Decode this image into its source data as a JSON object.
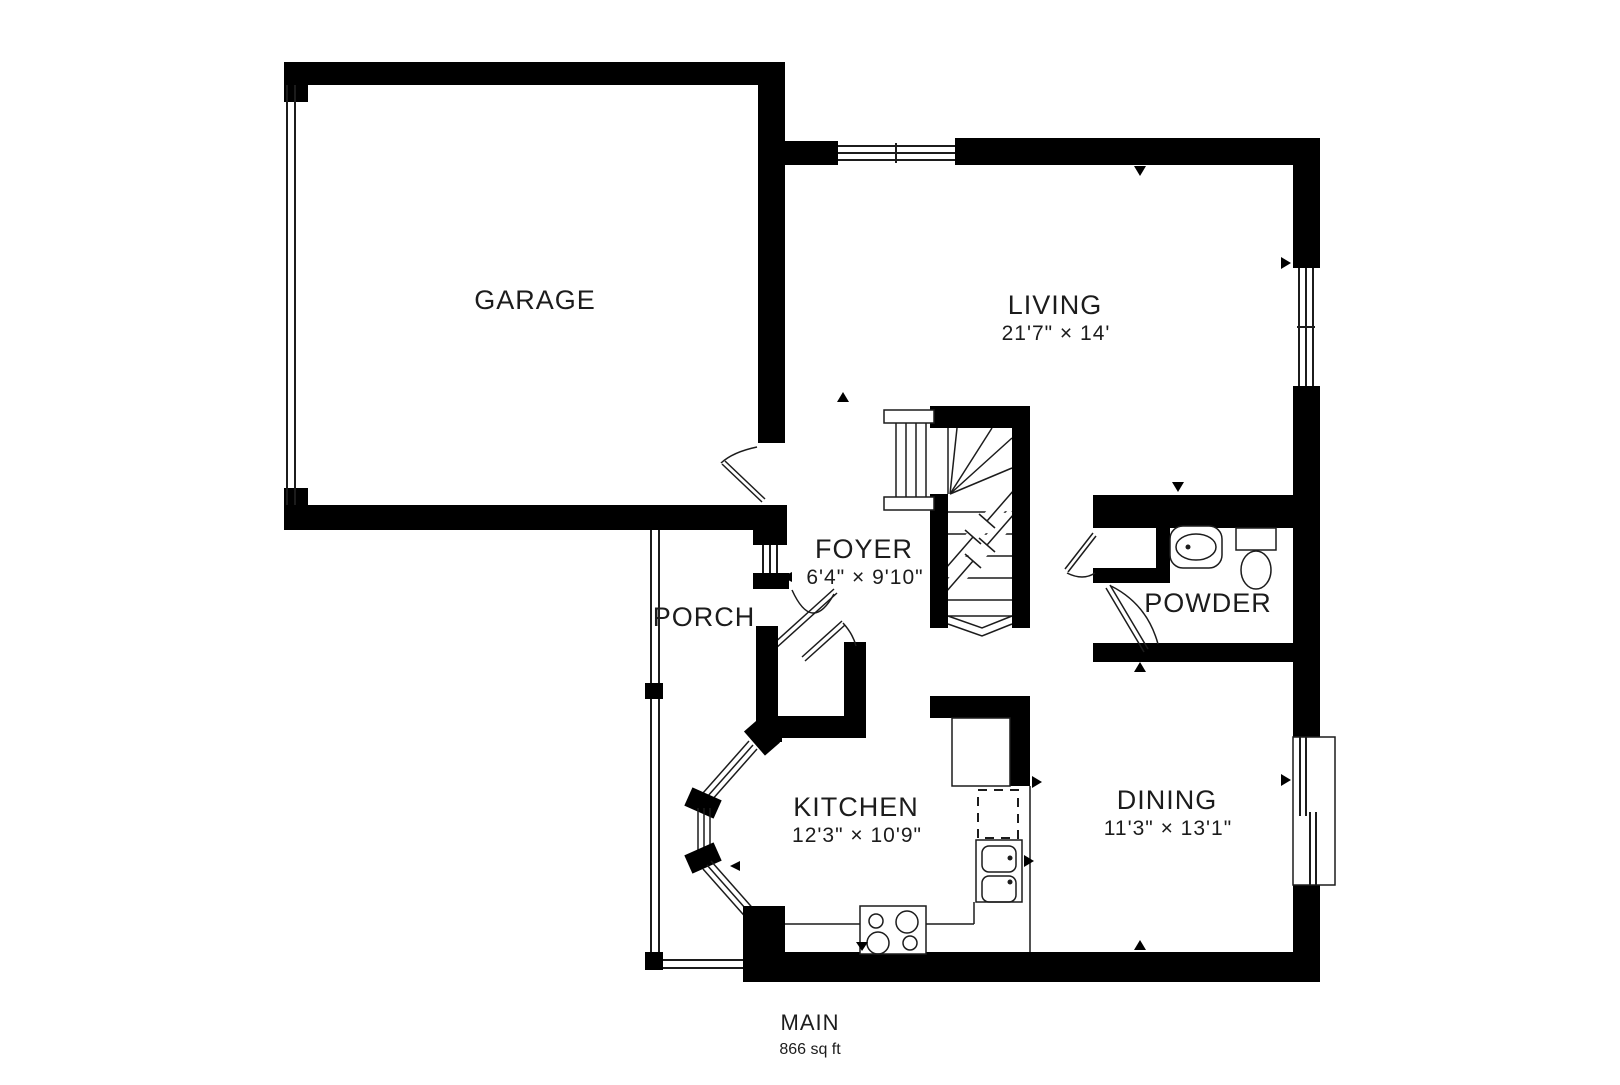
{
  "plan": {
    "floor_label": "MAIN",
    "floor_area": "866 sq ft",
    "rooms": [
      {
        "name": "GARAGE",
        "dims": ""
      },
      {
        "name": "LIVING",
        "dims": "21'7\" × 14'"
      },
      {
        "name": "FOYER",
        "dims": "6'4\" × 9'10\""
      },
      {
        "name": "PORCH",
        "dims": ""
      },
      {
        "name": "POWDER",
        "dims": ""
      },
      {
        "name": "KITCHEN",
        "dims": "12'3\" × 10'9\""
      },
      {
        "name": "DINING",
        "dims": "11'3\" × 13'1\""
      }
    ],
    "colors": {
      "wall": "#000000",
      "line": "#1c1c1c",
      "background": "#ffffff"
    }
  }
}
